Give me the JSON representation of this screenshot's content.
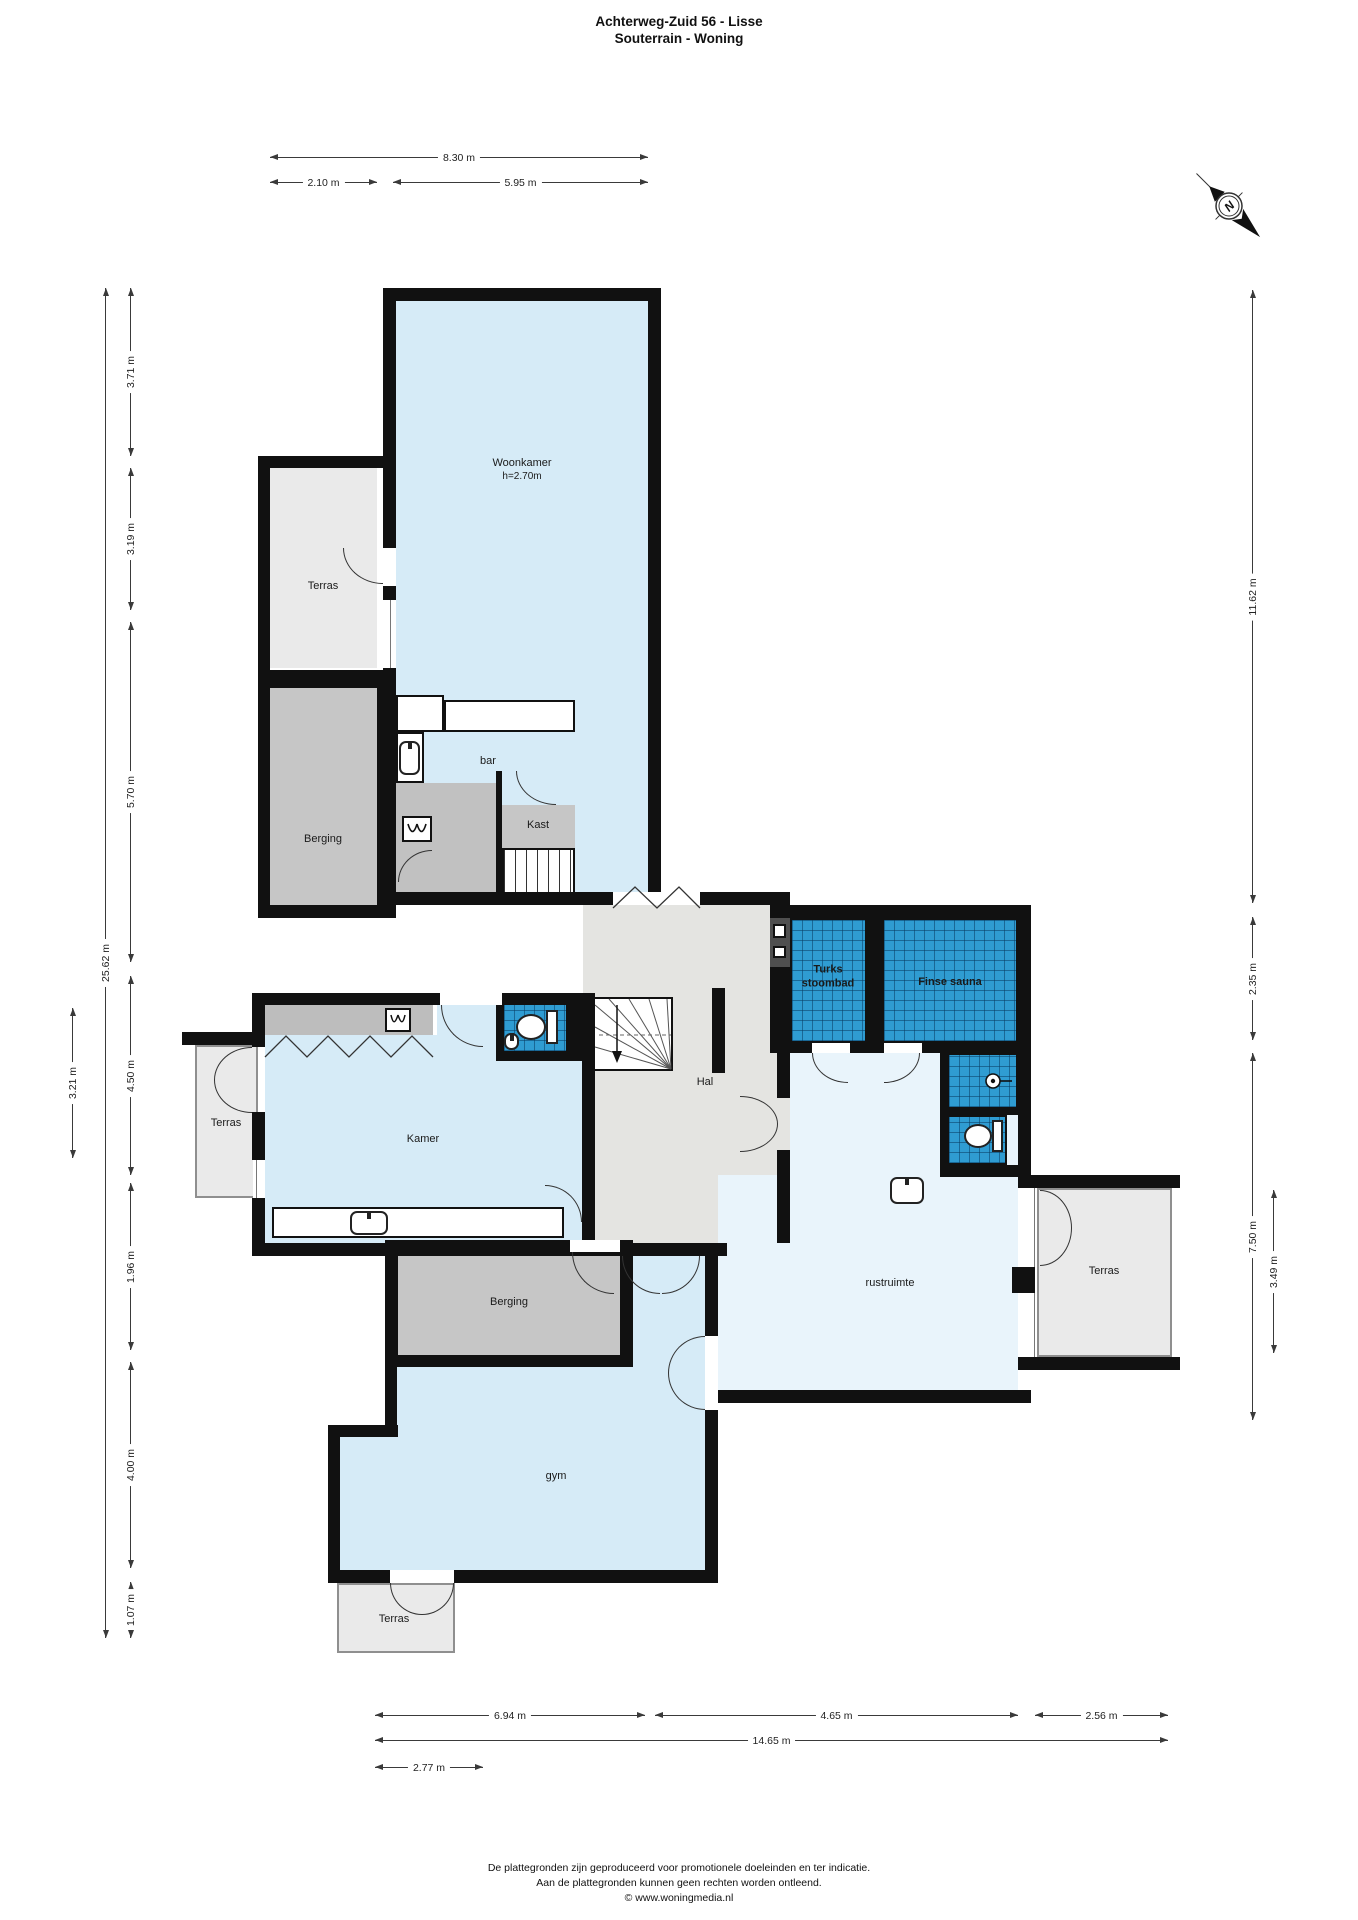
{
  "title": {
    "line1": "Achterweg-Zuid 56 - Lisse",
    "line2": "Souterrain - Woning"
  },
  "compass": {
    "label": "N"
  },
  "rooms": {
    "woonkamer": {
      "name": "Woonkamer",
      "height": "h=2.70m"
    },
    "terras_top": {
      "name": "Terras"
    },
    "berging_top": {
      "name": "Berging"
    },
    "bar": {
      "name": "bar"
    },
    "kast": {
      "name": "Kast"
    },
    "kamer": {
      "name": "Kamer"
    },
    "hal": {
      "name": "Hal"
    },
    "terras_left": {
      "name": "Terras"
    },
    "turks_stoombad": {
      "name": "Turks stoombad"
    },
    "finse_sauna": {
      "name": "Finse sauna"
    },
    "rustruimte": {
      "name": "rustruimte"
    },
    "terras_right": {
      "name": "Terras"
    },
    "berging_mid": {
      "name": "Berging"
    },
    "gym": {
      "name": "gym"
    },
    "terras_bottom": {
      "name": "Terras"
    }
  },
  "dims": {
    "top": [
      "8.30 m",
      "2.10 m",
      "5.95 m"
    ],
    "left_outer": "3.21 m",
    "left_total": "25.62 m",
    "left": [
      "3.71 m",
      "3.19 m",
      "5.70 m",
      "4.50 m",
      "1.96 m",
      "4.00 m",
      "1.07 m"
    ],
    "right": [
      "11.62 m",
      "2.35 m",
      "7.50 m"
    ],
    "right_inner": "3.49 m",
    "bottom": [
      "6.94 m",
      "4.65 m",
      "2.56 m"
    ],
    "bottom_total": "14.65 m",
    "bottom_inner": "2.77 m"
  },
  "footer": {
    "line1": "De plattegronden zijn geproduceerd voor promotionele doeleinden en ter indicatie.",
    "line2": "Aan de plattegronden kunnen geen rechten worden ontleend.",
    "line3": "© www.woningmedia.nl"
  }
}
